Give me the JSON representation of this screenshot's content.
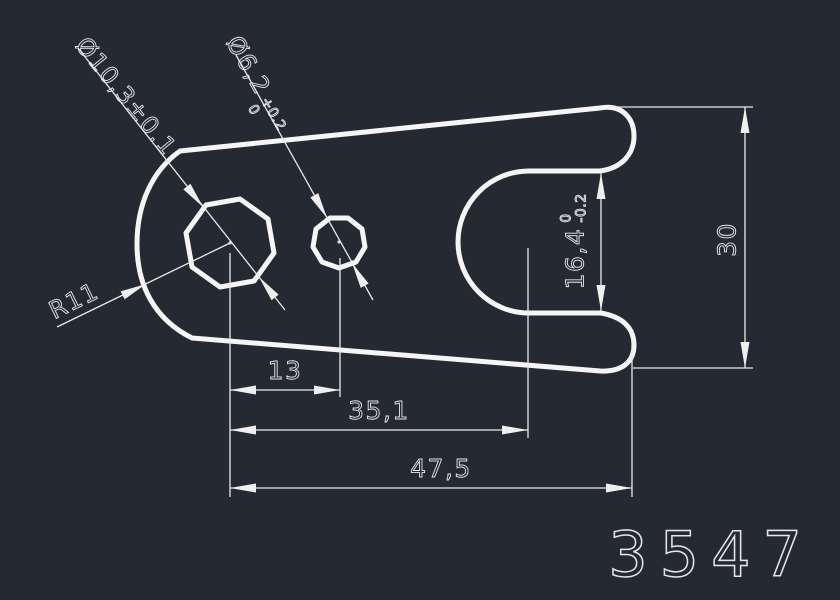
{
  "drawing": {
    "part_number": "3547",
    "annotations": {
      "hole_large_diameter": "Ø10,3±0.1",
      "hole_small_diameter": "Ø6,2",
      "hole_small_tol_upper": "+0.2",
      "hole_small_tol_lower": "0",
      "outer_radius": "R11",
      "slot_width": "16,4",
      "slot_width_tol_upper": "0",
      "slot_width_tol_lower": "-0.2",
      "hole_spacing": "13",
      "slot_center_distance": "35,1",
      "overall_length": "47,5",
      "overall_height": "30"
    }
  },
  "colors": {
    "background": "#252931",
    "outline": "#f5f5f5",
    "dimension_lines": "#e9e9e9",
    "text": "#e6e6e6"
  }
}
